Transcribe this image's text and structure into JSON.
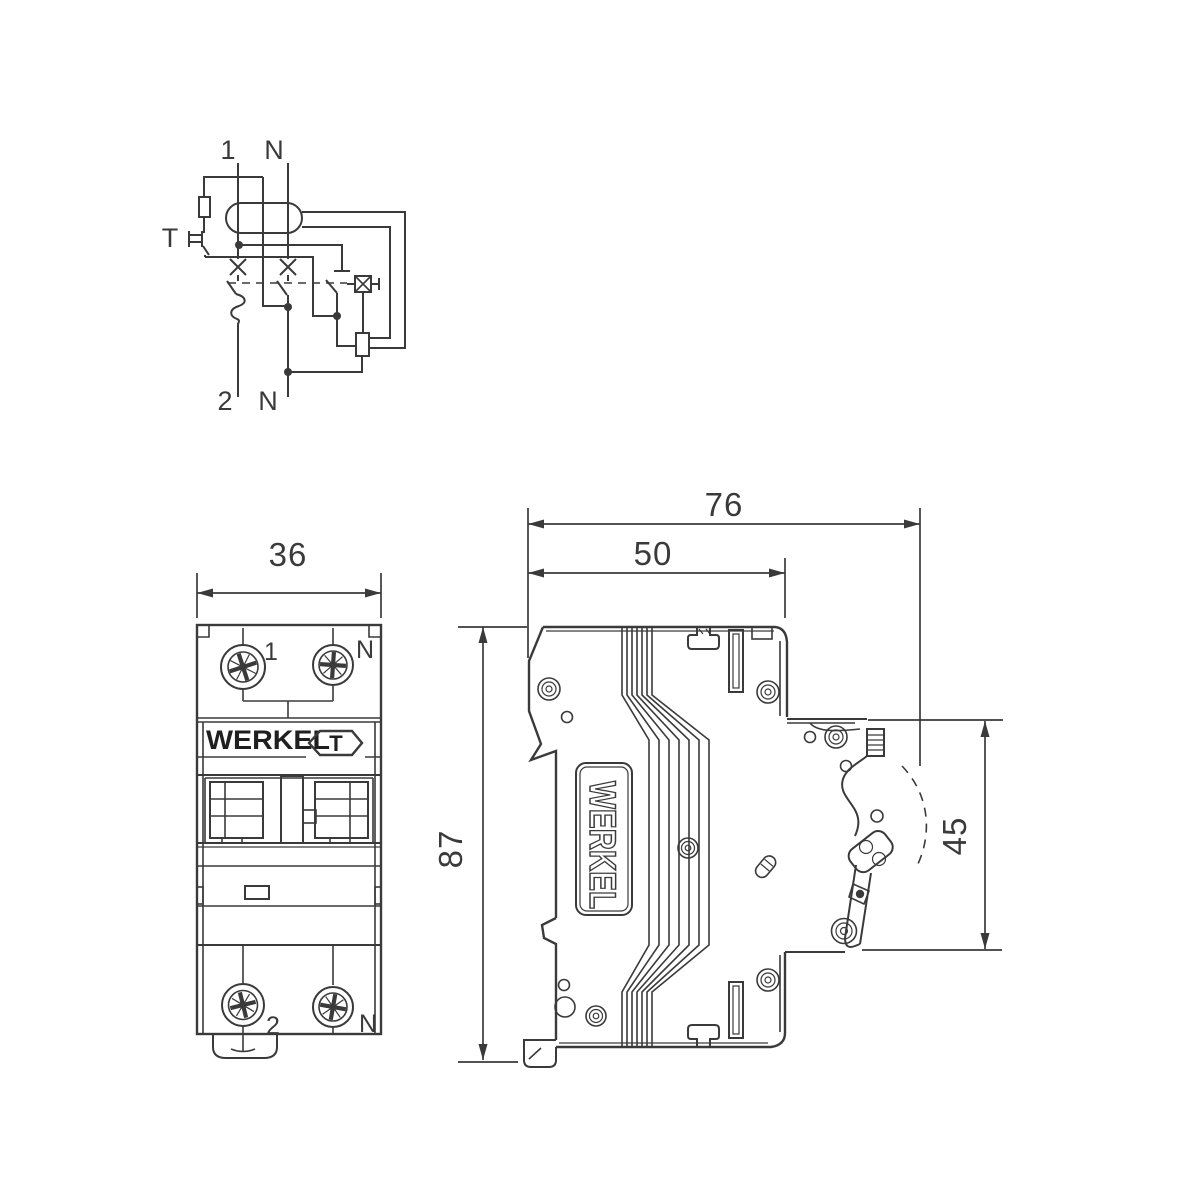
{
  "page": {
    "background": "#ffffff",
    "line_color": "#3a3a3a",
    "description": "Werkel RCBO circuit breaker technical drawing with wiring schematic, front view and side view"
  },
  "schematic": {
    "labels": {
      "line_in": "1",
      "neutral_in": "N",
      "test": "T",
      "line_out": "2",
      "neutral_out": "N"
    }
  },
  "front_view": {
    "dimension_width": "36",
    "terminal_top_left": "1",
    "terminal_top_right": "N",
    "brand": "WERKEL",
    "test_button": "T",
    "terminal_bottom_left": "2",
    "terminal_bottom_right": "N"
  },
  "side_view": {
    "brand": "WERKEL",
    "dimension_depth_total": "76",
    "dimension_depth_body": "50",
    "dimension_height": "87",
    "dimension_front_height": "45"
  }
}
